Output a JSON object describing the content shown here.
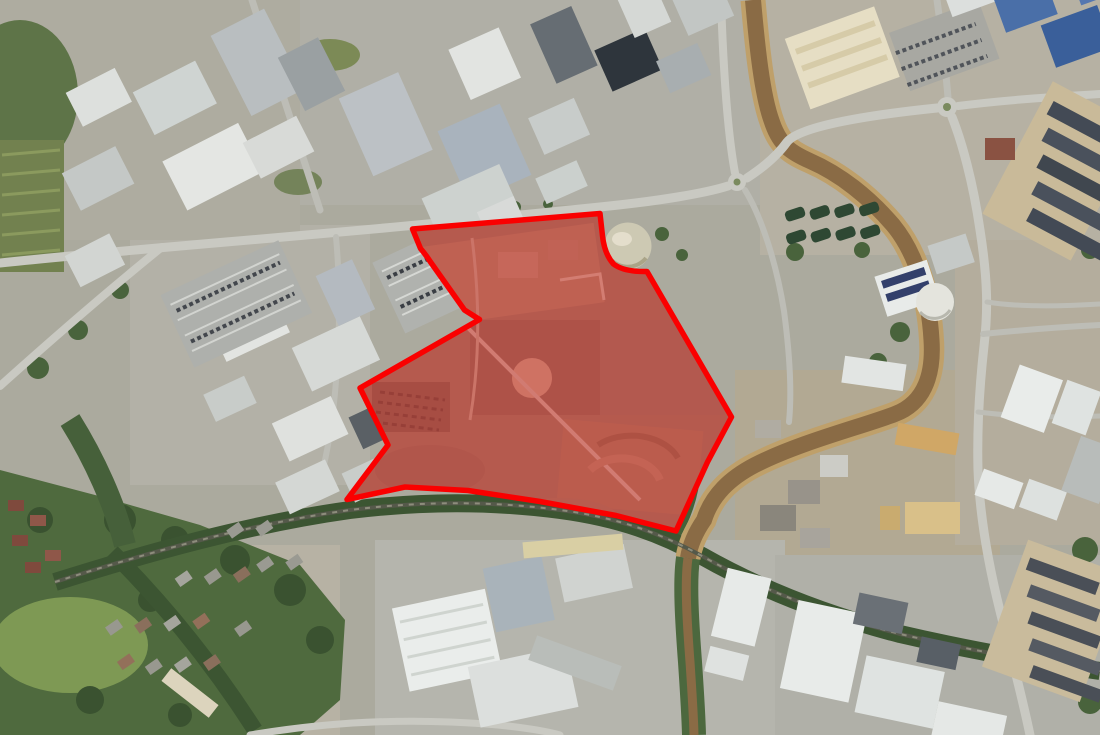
{
  "page": {
    "kind": "aerial-site-plan",
    "description_name": "satellite-photo-with-red-site-boundary"
  },
  "site_boundary": {
    "path": "M412.5 229 L600 213.5 L602.5 236 Q604.5 254 613.5 264 Q624 272 647 271.5 L731.5 417 L707.5 462 L676 531 L616 515.5 L540 501.5 L468 490.5 L405 487 L347 499.5 L388 445 L360 388 L479.5 319.5 L464.5 310 L430.5 262 Q426 255 420.5 248.5 Z",
    "stroke_color": "#fa0000",
    "stroke_width": 5.5,
    "fill_color": "#d92b2b",
    "fill_opacity": 0.46
  },
  "map_features": {
    "river": {
      "upper_path": "M753 0 C757 45 762 95 772 122 C780 146 792 153 810 161 C840 174 869 197 893 225 C916 253 929 295 931.5 340 C934 378 922 404 895 414 C864 426 800 442 755 465 C730 478 712 495 704 520 C695 533 690 545 688 558",
      "lower_path": "M688 558 C684.5 582 687 622 690 662 C692 692 693.5 714 694 735",
      "water_color": "#8a6b45",
      "bank_color": "#bfa06a",
      "south_bank_color": "#4c683e"
    },
    "railway": {
      "path": "M55 582 C150 552 250 524 350 510 C430 500 500 502 560 510 C620 518 662 534 702 556 C762 590 830 616 900 634 C960 648 1030 661 1100 671",
      "track_color": "#55594a",
      "tie_color": "#8d8d7c",
      "tree_color": "#3c5532"
    },
    "roads": {
      "color": "#c9c9c2",
      "minor_color": "#bdbdb6",
      "main_west": {
        "d": "M0 263 C160 246 320 236 600 207 C660 201 706 193 728 186"
      },
      "bridge_east": {
        "d": "M747 178 C764 167 777 156 787 142 C799 127 860 116 937 108"
      },
      "north_road": {
        "d": "M735 173 C727 130 723 60 721 0"
      },
      "northeast_road": {
        "d": "M948 97 C945 62 941 28 937 0"
      },
      "east_road": {
        "d": "M958 106 C1005 100 1052 97 1100 94"
      },
      "south_road": {
        "d": "M952 117 C962 142 973 182 980 230 C988 281 988 312 984 346 C979 391 977 431 978 470 C980 521 990 571 1000 611 C1010 651 1022 696 1030 735"
      },
      "crossroad_east": {
        "d": "M983 334 C1022 330 1060 327 1100 325"
      },
      "west_diagonal": {
        "d": "M162 247 C120 281 60 332 0 386"
      },
      "topleft_diagonal": {
        "d": "M252 0 C274 68 297 139 320 210"
      },
      "scrapyard_lane": {
        "d": "M745 190 C761 216 776 261 784 311 C790 356 792 392 789 422"
      },
      "west_side_lane": {
        "d": "M336 237 C340 281 340 331 336 381 C333 421 328 451 320 481"
      },
      "bottom_road": {
        "d": "M250 735 C310 725 380 719 450 722 C505 724 542 730 560 735"
      },
      "residential_lane_1": {
        "d": "M987 302 C1012 306 1052 307 1100 304"
      },
      "residential_lane_2": {
        "d": "M978 412 C1010 416 1052 418 1100 416"
      }
    },
    "roundabout_west": {
      "cx": 737,
      "cy": 182,
      "r": 9
    },
    "roundabout_east": {
      "cx": 947,
      "cy": 107,
      "r": 10
    },
    "gas_holder": {
      "cx": 628,
      "cy": 246,
      "r": 23.5,
      "color": "#cdc9b3"
    },
    "white_tank": {
      "cx": 935,
      "cy": 302,
      "r": 19,
      "color": "#e4e4dd"
    },
    "site_ground_color": "#97826c",
    "base_ground_color": "#abaa9e",
    "park_color": "#4f6a3e",
    "grass_color": "#7e9954",
    "tree_color": "#3a5230"
  }
}
